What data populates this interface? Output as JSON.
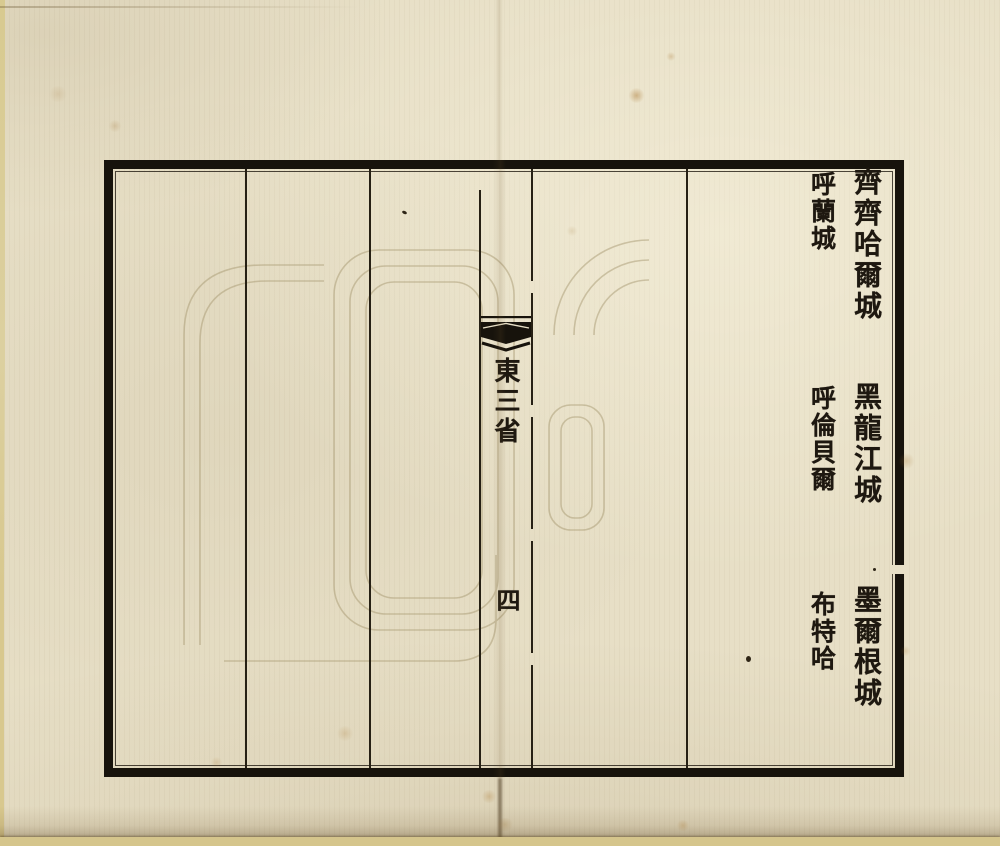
{
  "page": {
    "banxin": {
      "section_title": "東三省",
      "page_number": "四"
    },
    "entries": [
      {
        "primary": "齊齊哈爾城",
        "secondary": "呼蘭城"
      },
      {
        "primary": "黑龍江城",
        "secondary": "呼倫貝爾"
      },
      {
        "primary": "墨爾根城",
        "secondary": "布特哈"
      }
    ],
    "colors": {
      "paper": "#e7dfc6",
      "ink": "#1e1810",
      "frame_border": "#17130c",
      "fold_strip": "#d5c58c"
    }
  }
}
